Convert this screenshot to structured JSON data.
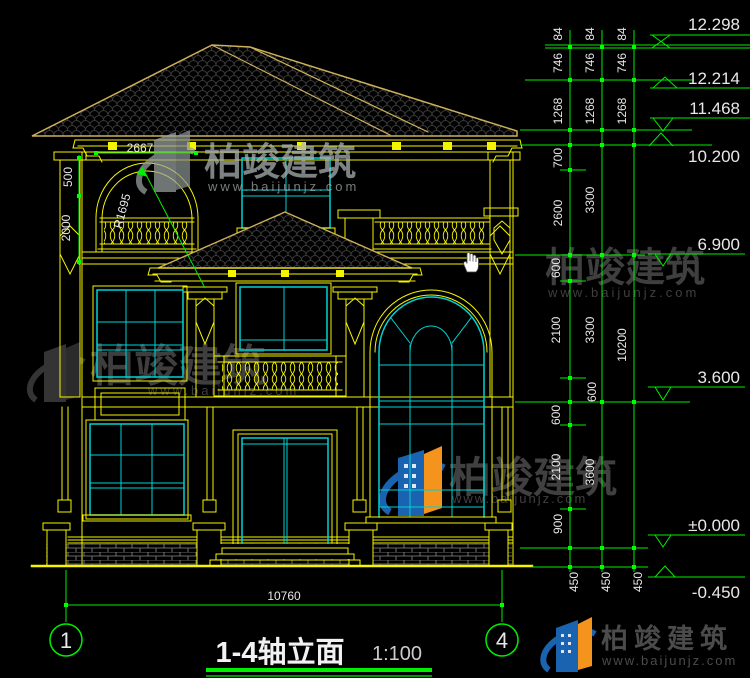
{
  "drawing": {
    "title": "1-4轴立面",
    "scale": "1:100",
    "axis_left": "1",
    "axis_right": "4",
    "bottom_width_dim": "10760",
    "annotations": {
      "arch_width": "2667",
      "dim_500": "500",
      "dim_2000": "2000",
      "arch_radius": "R1695"
    },
    "elevations": [
      "12.298",
      "12.214",
      "11.468",
      "10.200",
      "6.900",
      "3.600",
      "±0.000",
      "-0.450"
    ],
    "roof_chain": [
      "84",
      "746",
      "1268"
    ],
    "chain_inner": [
      "700",
      "2600",
      "600",
      "2100",
      "600",
      "600",
      "2100",
      "900",
      "450"
    ],
    "chain_mid": [
      "3300",
      "3300",
      "3600",
      "450"
    ],
    "chain_outer": [
      "10200",
      "450"
    ]
  },
  "watermark": {
    "brand": "柏竣建筑",
    "url": "www.baijunjz.com"
  },
  "footer": {
    "brand": "柏竣建筑",
    "url": "www.baijunjz.com"
  },
  "colors": {
    "line_yellow": "#f5f500",
    "roof_tan": "#cdb05a",
    "window_cyan": "#00d2d2",
    "dim_green": "#00ef00",
    "text_white": "#e8e8e8",
    "brand_blue": "#1a63b0",
    "brand_orange": "#f5941d"
  }
}
